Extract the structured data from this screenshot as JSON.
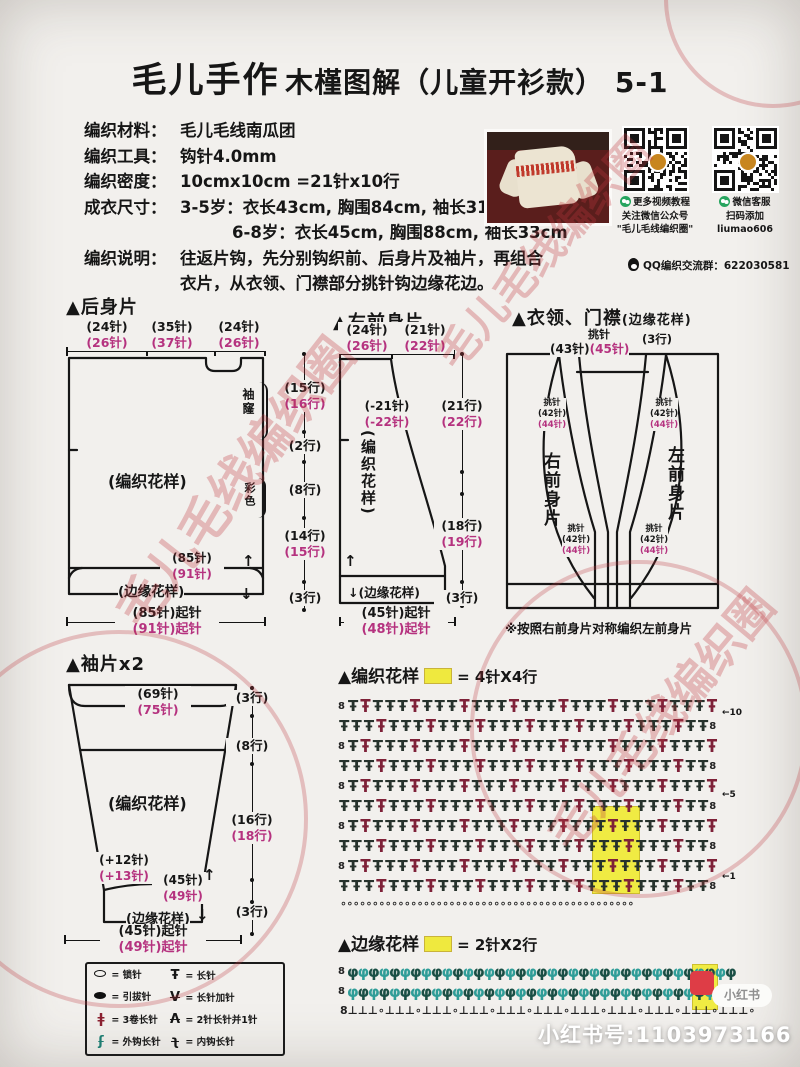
{
  "title": {
    "brand": "毛儿手作",
    "rest": "木槿图解（儿童开衫款） 5-1"
  },
  "info": {
    "rows": [
      {
        "label": "编织材料：",
        "value": "毛儿毛线南瓜团"
      },
      {
        "label": "编织工具：",
        "value": "钩针4.0mm"
      },
      {
        "label": "编织密度：",
        "value": "10cmx10cm =21针x10行"
      },
      {
        "label": "成衣尺寸：",
        "value": "3-5岁：衣长43cm, 胸围84cm, 袖长31cm"
      },
      {
        "label": "",
        "value": "6-8岁：衣长45cm, 胸围88cm, 袖长33cm"
      },
      {
        "label": "编织说明：",
        "value": "往返片钩，先分别钩织前、后身片及袖片，再组合"
      },
      {
        "label": "",
        "value": "衣片，从衣领、门襟部分挑针钩边缘花边。"
      }
    ]
  },
  "qr": {
    "qr1_caption": [
      "更多视频教程",
      "关注微信公众号",
      "\"毛儿毛线编织圈\""
    ],
    "qr2_caption": [
      "微信客服",
      "扫码添加",
      "liumao606"
    ],
    "qq_line": "QQ编织交流群：622030581"
  },
  "back": {
    "heading": "▲后身片",
    "dims_top": [
      {
        "s1": "(24针)",
        "s2": "(26针)"
      },
      {
        "s1": "(35针)",
        "s2": "(37针)"
      },
      {
        "s1": "(24针)",
        "s2": "(26针)"
      }
    ],
    "armhole": "袖窿",
    "colorwork": "彩色",
    "pattern": "(编织花样)",
    "hem_sts": {
      "s1": "(85针)",
      "s2": "(91针)"
    },
    "hem": "(边缘花样)",
    "cast_on": {
      "s1": "(85针)起针",
      "s2": "(91针)起针"
    }
  },
  "mid_dims": [
    {
      "s1": "(15行)",
      "s2": "(16行)"
    },
    {
      "s1": "(2行)",
      "s2": ""
    },
    {
      "s1": "(8行)",
      "s2": ""
    },
    {
      "s1": "(14行)",
      "s2": "(15行)"
    },
    {
      "s1": "(3行)",
      "s2": ""
    }
  ],
  "right_front": {
    "heading": "▲右前身片",
    "dims_top": [
      {
        "s1": "(24针)",
        "s2": "(26针)"
      },
      {
        "s1": "(21针)",
        "s2": "(22针)"
      }
    ],
    "neck_dec": {
      "s1": "(-21针)",
      "s2": "(-22针)"
    },
    "pattern": "(编织花样)",
    "dims_right": [
      {
        "s1": "(21行)",
        "s2": "(22行)"
      },
      {
        "s1": "(18行)",
        "s2": "(19行)"
      },
      {
        "s1": "(3行)",
        "s2": ""
      }
    ],
    "hem": "(边缘花样)",
    "hem_arrow": "↓",
    "up_arrow": "↑",
    "cast_on": {
      "s1": "(45针)起针",
      "s2": "(48针)起针"
    }
  },
  "collar": {
    "heading": "▲衣领、门襟",
    "heading_sub": "(边缘花样)",
    "pickup": "挑针",
    "top_sts": {
      "s1": "(43针)",
      "s2": "(45针)"
    },
    "top_rows": "(3行)",
    "side_sts": {
      "s1": "(42针)",
      "s2": "(44针)"
    },
    "label_right_piece": "右前身片",
    "label_left_piece": "左前身片",
    "note": "※按照右前身片对称编织左前身片"
  },
  "sleeve": {
    "heading": "▲袖片x2",
    "top_sts": {
      "s1": "(69针)",
      "s2": "(75针)"
    },
    "dims_right": [
      {
        "s1": "(3行)",
        "s2": ""
      },
      {
        "s1": "(8行)",
        "s2": ""
      },
      {
        "s1": "(16行)",
        "s2": "(18行)"
      },
      {
        "s1": "(3行)",
        "s2": ""
      }
    ],
    "pattern": "(编织花样)",
    "inc": {
      "s1": "(+12针)",
      "s2": "(+13针)"
    },
    "hem_sts": {
      "s1": "(45针)",
      "s2": "(49针)"
    },
    "hem": "(边缘花样)",
    "up_arrow": "↑",
    "down_arrow": "↓",
    "cast_on": {
      "s1": "(45针)起针",
      "s2": "(49针)起针"
    }
  },
  "legend": {
    "eq": "=",
    "left": [
      {
        "label": "锁针"
      },
      {
        "label": "引拔针"
      },
      {
        "label": "3卷长针"
      },
      {
        "label": "外钩长针"
      }
    ],
    "right": [
      {
        "label": "长针"
      },
      {
        "label": "长针加针"
      },
      {
        "label": "2针长针并1针"
      },
      {
        "label": "内钩长针"
      }
    ]
  },
  "main_chart": {
    "heading": "▲编织花样",
    "key": "= 4针X4行",
    "rows": 10,
    "cols": 30,
    "markers": {
      "m10": "←10",
      "m5": "←5",
      "m1": "←1"
    }
  },
  "edge_chart": {
    "heading": "▲边缘花样",
    "key": "= 2针X2行",
    "cols": 37,
    "marker": "←1"
  },
  "footer": {
    "xhs_badge": "小红书",
    "xhs_id": "小红书号:1103973166"
  },
  "watermark": {
    "stamp": "毛儿毛线编织圈"
  }
}
